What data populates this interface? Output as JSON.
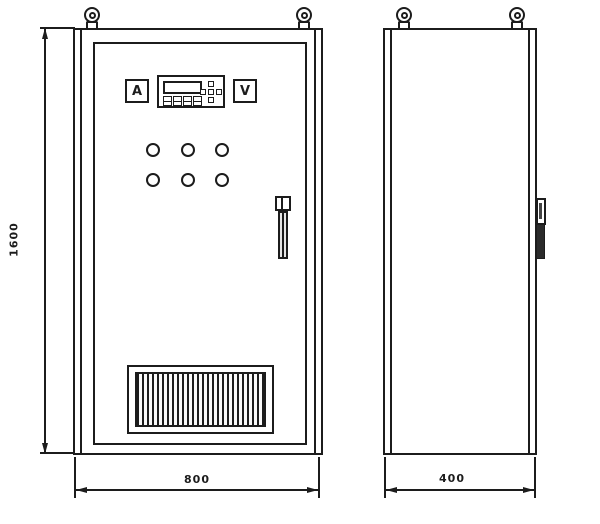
{
  "drawing": {
    "type": "engineering-drawing",
    "subject": "electrical control cabinet, front and side elevation views"
  },
  "panel": {
    "ammeter_label": "A",
    "voltmeter_label": "V"
  },
  "front_view": {
    "indicator_light_count": 6,
    "lifting_eye_count": 2,
    "has_vent_grille": true,
    "has_door_handle": true
  },
  "side_view": {
    "lifting_eye_count": 2,
    "has_handle_profile": true
  },
  "dimensions": {
    "height": "1600",
    "width": "800",
    "depth": "400"
  },
  "colors": {
    "line": "#1c1c1c",
    "background": "#ffffff",
    "handle_fill": "#2b2b2b"
  }
}
